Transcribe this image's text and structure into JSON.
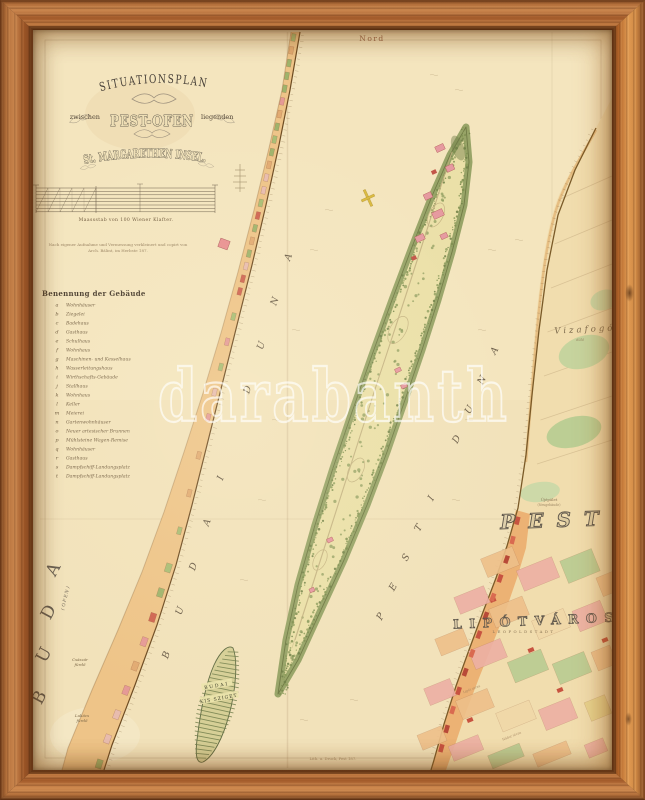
{
  "photo": {
    "description": "Framed antique situational map of St. Margarethen Insel between Pest and Ofen",
    "frame_material": "wood"
  },
  "map": {
    "north_label": "Nord",
    "title": {
      "line1": "SITUATIONSPLAN",
      "line2_prefix": "zwischen",
      "line2_main": "PEST-OFEN",
      "line2_suffix": "liegenden",
      "line3": "St. MARGARETHEN INSEL."
    },
    "scale_caption": "Maassstab von 100 Wiener Klafter.",
    "imprint_line1": "Nach eigener Aufnahme und Vermessung verkleinert und copirt von",
    "imprint_line2": "Arch. Bálint, im Herbste 187.",
    "legend": {
      "title": "Benennung der Gebäude",
      "items": [
        {
          "letter": "a",
          "name": "Wohnhäuser"
        },
        {
          "letter": "b",
          "name": "Ziegelei"
        },
        {
          "letter": "c",
          "name": "Badehaus"
        },
        {
          "letter": "d",
          "name": "Gasthaus"
        },
        {
          "letter": "e",
          "name": "Schulhaus"
        },
        {
          "letter": "f",
          "name": "Wohnhaus"
        },
        {
          "letter": "g",
          "name": "Maschinen- und Kesselhaus"
        },
        {
          "letter": "h",
          "name": "Wasserleitungshaus"
        },
        {
          "letter": "i",
          "name": "Wirthschafts-Gebäude"
        },
        {
          "letter": "j",
          "name": "Stallhaus"
        },
        {
          "letter": "k",
          "name": "Wohnhaus"
        },
        {
          "letter": "l",
          "name": "Keller"
        },
        {
          "letter": "m",
          "name": "Meierei"
        },
        {
          "letter": "n",
          "name": "Gartenwohnhäuser"
        },
        {
          "letter": "o",
          "name": "Neuer artesischer Brunnen"
        },
        {
          "letter": "p",
          "name": "Mühlsteine Wagen-Remise"
        },
        {
          "letter": "q",
          "name": "Wohnhäuser"
        },
        {
          "letter": "r",
          "name": "Gasthaus"
        },
        {
          "letter": "s",
          "name": "Dampfschiff-Landungsplatz"
        },
        {
          "letter": "t",
          "name": "Dampfschiff-Landungsplatz"
        }
      ]
    },
    "labels": {
      "buda": "BUDA",
      "buda_sub": "(OFEN)",
      "pest": "PEST",
      "lipotvaros": "LIPÓTVÁROS",
      "lipotvaros_sub": "LEOPOLDSTADT",
      "vizafogo": "Vizafogó",
      "vizafogo_sub": "dűlő",
      "ujepulet_line1": "Újépület",
      "ujepulet_line2": "(Neugebäude)",
      "kis_sziget_line1": "BUDAI",
      "kis_sziget_line2": "KIS SZIGET",
      "river_left": "BUDAI DUNA",
      "river_right": "PESTI DUNA",
      "csaszar_line1": "Császár",
      "csaszar_line2": "fürdő",
      "lukacs_line1": "Lukács",
      "lukacs_line2": "fürdő",
      "city_label1": "Lipót utcza",
      "city_label2": "Nádor utcza",
      "bottom_imprint": "Lith. u. Druck, Pest 187."
    },
    "watermark": "darabanth",
    "colors": {
      "paper": "#f2e2ba",
      "frame_wood": "#b5713c",
      "island_green": "#8a9a58",
      "shore_orange": "#eec488",
      "building_pink": "#e59a96",
      "building_red": "#c75340",
      "park_green": "#b9cc92",
      "ink": "#4a3d2e",
      "watermark_white": "#ffffff"
    }
  }
}
